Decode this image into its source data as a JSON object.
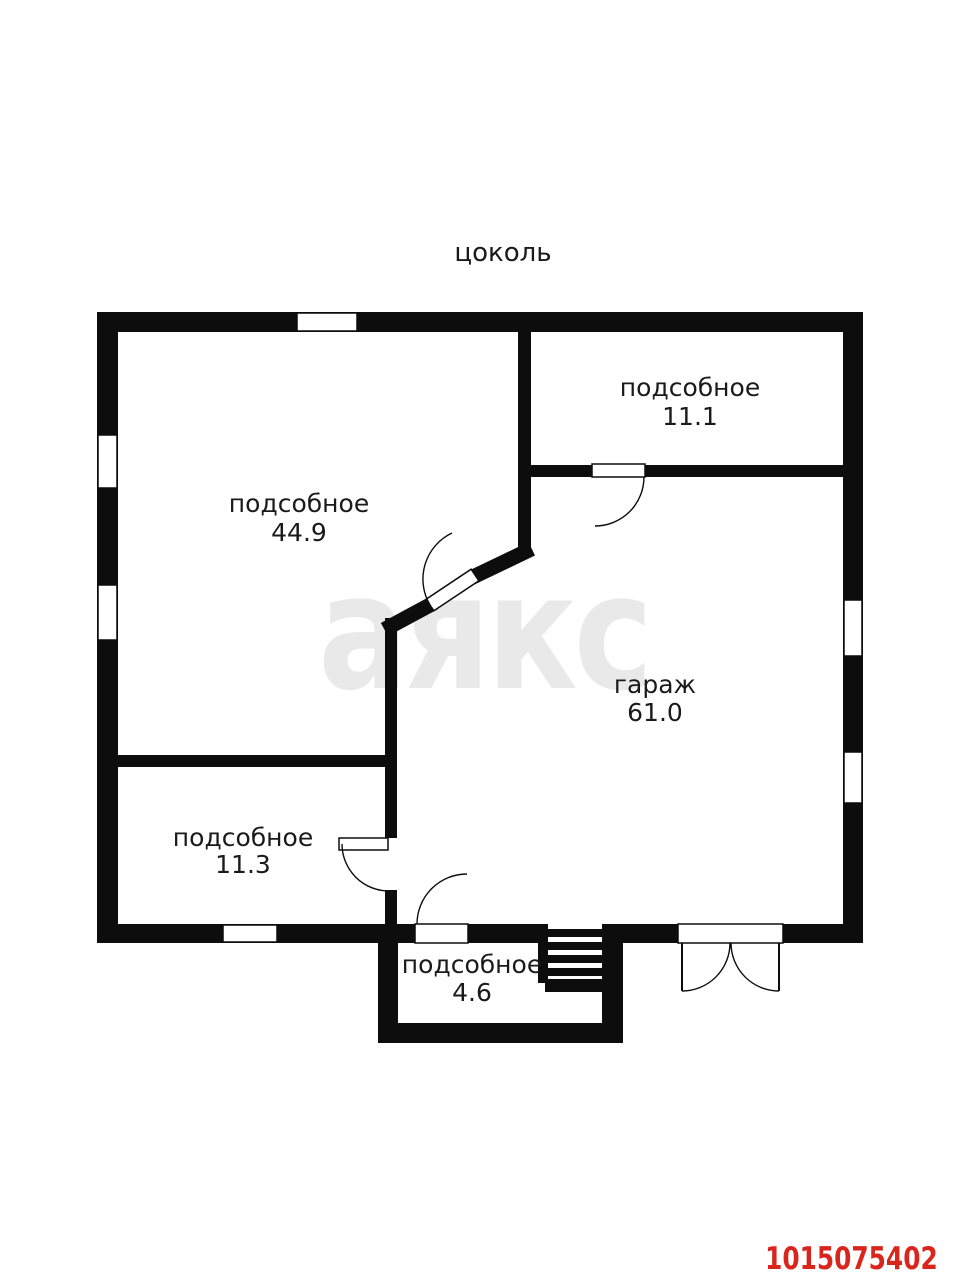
{
  "page": {
    "title": "цоколь",
    "watermark": "аякс",
    "listing_id": "1015075402"
  },
  "rooms": [
    {
      "name": "подсобное",
      "area": "44.9"
    },
    {
      "name": "подсобное",
      "area": "11.1"
    },
    {
      "name": "гараж",
      "area": "61.0"
    },
    {
      "name": "подсобное",
      "area": "11.3"
    },
    {
      "name": "подсобное",
      "area": "4.6"
    }
  ],
  "colors": {
    "wall": "#0d0d0d",
    "label_text": "#1a1a1a",
    "watermark_gray": "#e9e9e9",
    "listing_id_red": "#da251d",
    "background": "#ffffff"
  }
}
